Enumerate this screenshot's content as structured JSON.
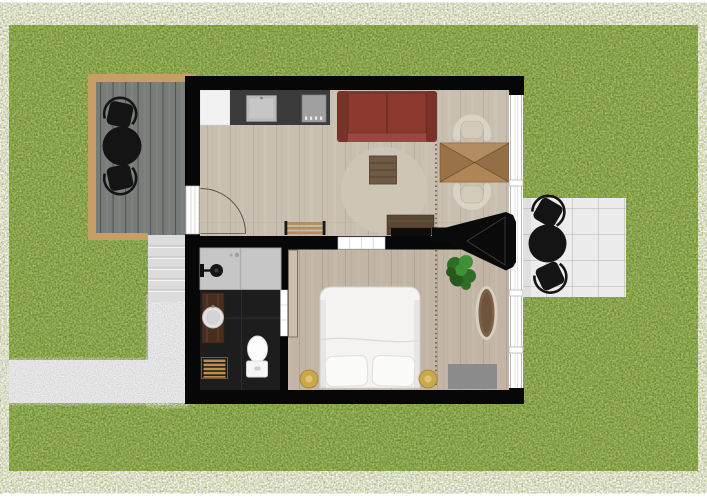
{
  "meta": {
    "view": "top-down-floor-plan",
    "canvas": {
      "width": 707,
      "height": 500
    }
  },
  "colors": {
    "grass": "#7ba33e",
    "gravel": "#e4e4e4",
    "steps": "#dcdcdc",
    "deck": "#797d79",
    "deck_border": "#c79f64",
    "wall": "#070707",
    "floor_living": "#c9bfb1",
    "floor_bedroom": "#c2b5a6",
    "floor_bath": "#1d1d1d",
    "counter": "#3b3b3b",
    "appliance": "#f2f2f2",
    "sink": "#b9b9b9",
    "cooktop": "#a0a0a0",
    "sofa": "#8c3a30",
    "rug": "#cdc5b6",
    "coffee_table": "#6f5a43",
    "console": "#5a4631",
    "bench": "#b08e5f",
    "table_wood": "#ab8050",
    "chair_cream": "#d9d3c6",
    "window_white": "#ffffff",
    "patio": "#ececec",
    "black_furniture": "#141414",
    "bed": "#f4f3f1",
    "lamp": "#c9a84c",
    "plant_dark": "#27591f",
    "plant_mid": "#2f6d27",
    "plant_light": "#3f9136",
    "rug_oval": "#7d6247",
    "rug_oval_border": "#d8cfc0",
    "mat_gray": "#8b8b8b",
    "vanity": "#4a2e1d",
    "shower": "#c6c6c6",
    "bathmat": "#bb8f4f",
    "cabinet": "#cdbfae"
  },
  "scene": {
    "outdoor_items": [
      "grass-lawn",
      "gravel-path",
      "entry-steps",
      "wood-deck",
      "deck-dining-set",
      "patio-terrace",
      "patio-dining-set"
    ],
    "rooms": [
      {
        "name": "living-kitchen",
        "furniture": [
          "refrigerator",
          "kitchen-counter",
          "kitchen-sink",
          "cooktop",
          "red-sofa",
          "round-area-rug",
          "coffee-table",
          "tv-console",
          "tv",
          "wood-bench",
          "dining-table",
          "dining-chair-top",
          "dining-chair-bottom",
          "entry-door",
          "sliding-door"
        ]
      },
      {
        "name": "bathroom",
        "furniture": [
          "walk-in-shower",
          "shower-head",
          "wood-vanity",
          "round-basin",
          "toilet",
          "bath-mat",
          "bathroom-door"
        ]
      },
      {
        "name": "bedroom",
        "furniture": [
          "double-bed",
          "pillow-left",
          "pillow-right",
          "bedside-lamp-left",
          "bedside-lamp-right",
          "potted-plant",
          "oval-rug",
          "gray-floor-mat",
          "tall-cabinet",
          "fireplace-flue"
        ]
      }
    ]
  }
}
